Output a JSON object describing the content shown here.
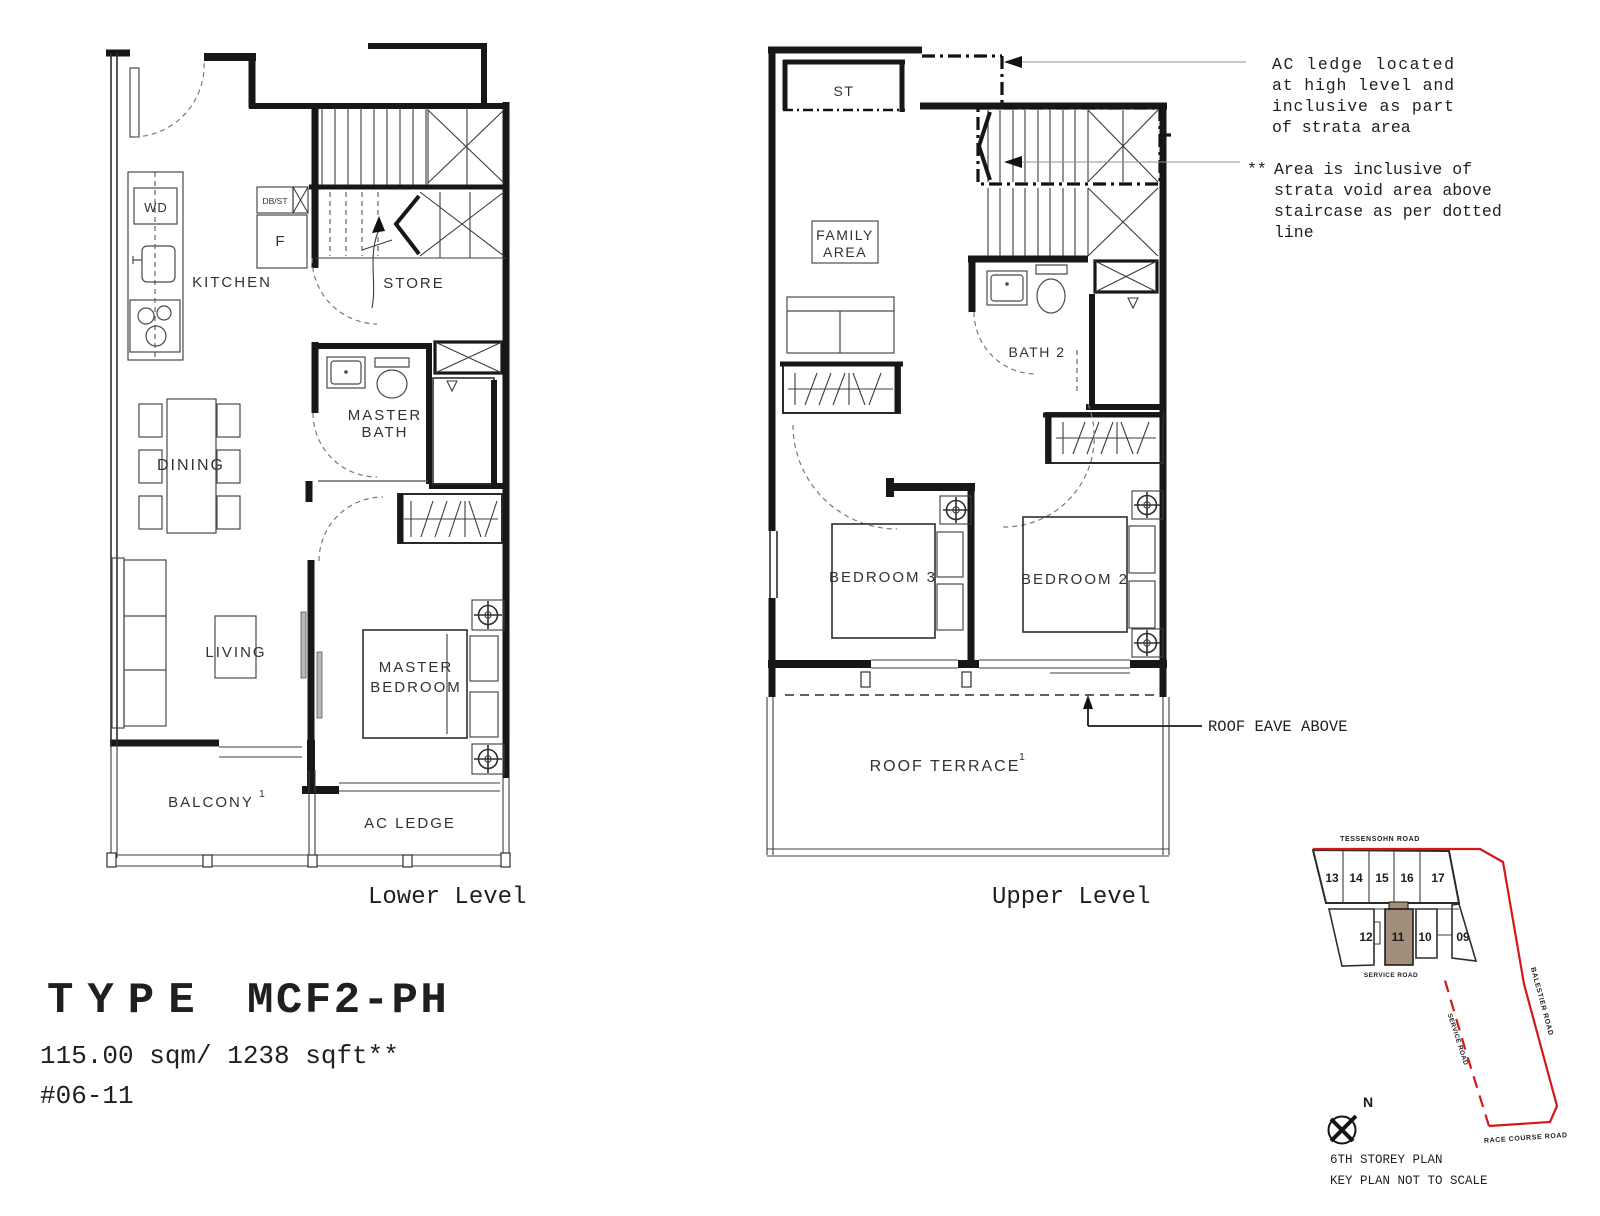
{
  "plans": {
    "lower": {
      "caption": "Lower Level",
      "labels": {
        "wd": "WD",
        "dbst": "DB/ST",
        "fridge": "F",
        "kitchen": "KITCHEN",
        "store": "STORE",
        "master_bath": {
          "l1": "MASTER",
          "l2": "BATH"
        },
        "dining": "DINING",
        "living": "LIVING",
        "master_bedroom": {
          "l1": "MASTER",
          "l2": "BEDROOM"
        },
        "balcony": "BALCONY",
        "balcony_sup": "1",
        "ac_ledge": "AC LEDGE"
      }
    },
    "upper": {
      "caption": "Upper Level",
      "labels": {
        "st": "ST",
        "family_area": {
          "l1": "FAMILY",
          "l2": "AREA"
        },
        "bath2": "BATH 2",
        "bedroom3": "BEDROOM 3",
        "bedroom2": "BEDROOM 2",
        "roof_terrace": "ROOF TERRACE",
        "roof_terrace_sup": "1"
      }
    }
  },
  "annotations": {
    "ac_note": {
      "l1": "AC ledge located",
      "l2": "at high level and",
      "l3": "inclusive as part",
      "l4": "of strata area"
    },
    "strata_note": {
      "marker": "**",
      "l1": "Area is inclusive of",
      "l2": "strata void area above",
      "l3": "staircase as per dotted",
      "l4": "line"
    },
    "roof_eave": "ROOF EAVE ABOVE"
  },
  "titleblock": {
    "type_word": "TYPE",
    "type_code": "MCF2-PH",
    "area": "115.00 sqm/ 1238 sqft**",
    "unit_no": "#06-11"
  },
  "keyplan": {
    "road_top": "TESSENSOHN ROAD",
    "road_service_top": "SERVICE ROAD",
    "road_service_diag": "SERVICE ROAD",
    "road_balestier": "BALESTIER ROAD",
    "road_race_course": "RACE COURSE ROAD",
    "units_top": [
      "13",
      "14",
      "15",
      "16",
      "17"
    ],
    "units_bottom": [
      "12",
      "11",
      "10",
      "09"
    ],
    "highlighted_unit": "11",
    "north": "N",
    "caption1": "6TH STOREY PLAN",
    "caption2": "KEY PLAN NOT TO SCALE",
    "colors": {
      "highlight": "#a28e7b",
      "boundary": "#d41717",
      "line": "#141414"
    }
  }
}
